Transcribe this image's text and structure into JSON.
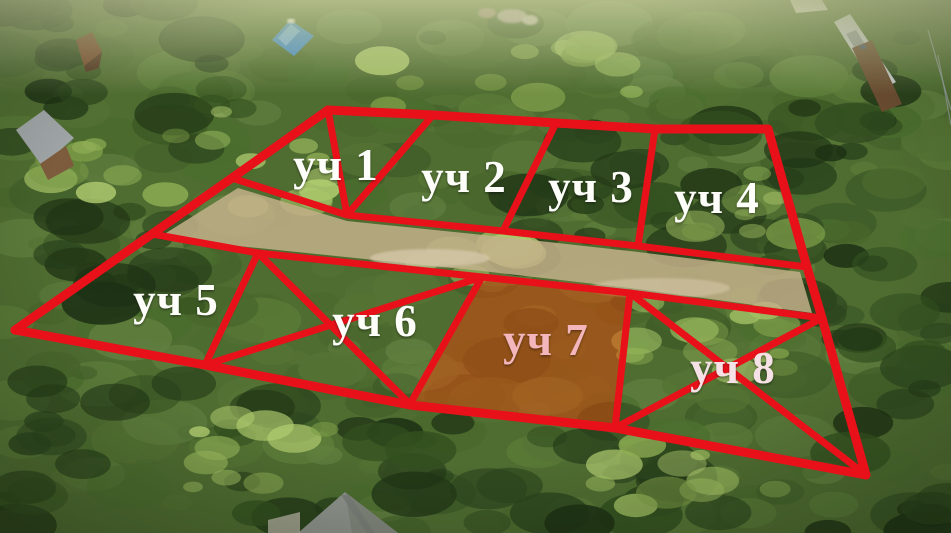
{
  "plots": [
    {
      "id": "1",
      "label": "уч 1",
      "x": 336,
      "y": 164,
      "color": "#fdfdfa"
    },
    {
      "id": "2",
      "label": "уч 2",
      "x": 464,
      "y": 176,
      "color": "#fdfdfa"
    },
    {
      "id": "3",
      "label": "уч 3",
      "x": 591,
      "y": 186,
      "color": "#fdfdfa"
    },
    {
      "id": "4",
      "label": "уч 4",
      "x": 717,
      "y": 197,
      "color": "#fdfdfa"
    },
    {
      "id": "5",
      "label": "уч 5",
      "x": 176,
      "y": 299,
      "color": "#fdfdfa"
    },
    {
      "id": "6",
      "label": "уч 6",
      "x": 375,
      "y": 320,
      "color": "#fdfdfa"
    },
    {
      "id": "7",
      "label": "уч 7",
      "x": 546,
      "y": 339,
      "color": "#f2b6bc"
    },
    {
      "id": "8",
      "label": "уч 8",
      "x": 733,
      "y": 367,
      "color": "#f6e2e6"
    }
  ],
  "overlay": {
    "stroke": "#e8111a",
    "outer_width": 9,
    "inner_width": 7,
    "highlight": {
      "name": "plot-7-highlight",
      "points": "482,277 630,293 615,428 410,404",
      "fill": "#ff3c00",
      "opacity": 0.42
    },
    "lines": [
      {
        "name": "outer-top-edge",
        "points": "328,110 433,115 556,123 655,129 768,129",
        "outer": true
      },
      {
        "name": "outer-right-edge",
        "points": "768,129 807,267 822,318 866,475",
        "outer": true
      },
      {
        "name": "outer-bottom-edge",
        "points": "15,330 205,365 410,405 615,428 866,475",
        "outer": true
      },
      {
        "name": "outer-left-edge",
        "points": "328,110 232,178 152,234 15,330",
        "outer": true
      },
      {
        "name": "road-top-edge",
        "points": "232,178 347,215 503,231 638,246 807,267",
        "outer": false
      },
      {
        "name": "road-bottom-edge",
        "points": "152,234 258,253 482,277 630,293 822,318",
        "outer": false
      },
      {
        "name": "divider-plots-1-2",
        "points": "433,115 347,215",
        "outer": false
      },
      {
        "name": "divider-plots-2-3",
        "points": "556,123 503,231",
        "outer": false
      },
      {
        "name": "divider-plots-3-4",
        "points": "655,129 638,246",
        "outer": false
      },
      {
        "name": "divider-plots-5-6",
        "points": "258,253 205,365",
        "outer": false
      },
      {
        "name": "divider-plots-6-7",
        "points": "482,277 410,404",
        "outer": false
      },
      {
        "name": "divider-plots-7-8",
        "points": "630,293 615,428",
        "outer": false
      },
      {
        "name": "plot-1-diagonal",
        "points": "328,110 347,215",
        "outer": false
      },
      {
        "name": "plot-6-diagonal-a",
        "points": "258,253 410,404",
        "outer": false
      },
      {
        "name": "plot-6-diagonal-b",
        "points": "482,277 205,365",
        "outer": false
      },
      {
        "name": "plot-8-diagonal-a",
        "points": "630,293 866,475",
        "outer": false
      },
      {
        "name": "plot-8-diagonal-b",
        "points": "822,318 615,428",
        "outer": false
      }
    ]
  },
  "photo": {
    "base_color": "#4f6c31",
    "haze_color": "#c9cf9e",
    "mid_palette": [
      "#49672c",
      "#557334",
      "#3f5c28",
      "#5d7d3a",
      "#4a6d2e",
      "#618040"
    ],
    "dark_palette": [
      "#243a18",
      "#2c451e",
      "#1d3114",
      "#33501f"
    ],
    "light_palette": [
      "#7d9c48",
      "#8fae55",
      "#a3c164",
      "#b4cf72",
      "#97b75c"
    ],
    "dark_regions": [
      [
        0,
        0,
        250,
        150,
        22
      ],
      [
        520,
        120,
        260,
        150,
        22
      ],
      [
        755,
        60,
        196,
        280,
        26
      ],
      [
        60,
        190,
        140,
        150,
        16
      ],
      [
        300,
        420,
        420,
        113,
        26
      ],
      [
        0,
        360,
        300,
        173,
        22
      ],
      [
        820,
        280,
        131,
        253,
        18
      ]
    ],
    "light_regions": [
      [
        150,
        110,
        180,
        110,
        12
      ],
      [
        180,
        415,
        150,
        80,
        10
      ],
      [
        615,
        290,
        200,
        100,
        14
      ],
      [
        360,
        40,
        300,
        70,
        12
      ],
      [
        600,
        430,
        180,
        80,
        10
      ],
      [
        20,
        140,
        120,
        80,
        8
      ],
      [
        420,
        240,
        120,
        40,
        6
      ],
      [
        690,
        170,
        110,
        80,
        8
      ]
    ],
    "features": [
      {
        "name": "dirt-road",
        "type": "poly",
        "points": "238,188 347,221 503,237 638,252 800,272 812,313 630,288 482,271 258,248 158,238",
        "fill": "#c3b08a",
        "opacity": 0.85
      },
      {
        "name": "road-gravel-patch-1",
        "type": "ellipse",
        "cx": 430,
        "cy": 258,
        "rx": 60,
        "ry": 9,
        "fill": "#d8cbae",
        "opacity": 0.7
      },
      {
        "name": "road-gravel-patch-2",
        "type": "ellipse",
        "cx": 660,
        "cy": 288,
        "rx": 70,
        "ry": 10,
        "fill": "#d4c6a6",
        "opacity": 0.6
      },
      {
        "name": "blue-roof-house",
        "type": "poly",
        "points": "272,40 290,20 314,36 294,56",
        "fill": "#3f87c7",
        "opacity": 1
      },
      {
        "name": "blue-roof-ridge",
        "type": "poly",
        "points": "278,38 291,24 300,31 286,46",
        "fill": "#6fa9dc",
        "opacity": 1
      },
      {
        "name": "blue-roof-chimney",
        "type": "ellipse",
        "cx": 291,
        "cy": 21,
        "rx": 4,
        "ry": 2.5,
        "fill": "#e8e4da",
        "opacity": 1
      },
      {
        "name": "brown-house-roof",
        "type": "poly",
        "points": "76,40 92,32 102,52 84,66",
        "fill": "#74452a",
        "opacity": 1
      },
      {
        "name": "brown-house-side",
        "type": "poly",
        "points": "84,66 102,52 99,68 86,72",
        "fill": "#4e2e1c",
        "opacity": 1
      },
      {
        "name": "left-house-roof",
        "type": "poly",
        "points": "16,130 44,110 74,138 42,166",
        "fill": "#9fa4a6",
        "opacity": 1
      },
      {
        "name": "left-house-wall",
        "type": "poly",
        "points": "40,164 66,146 74,166 48,180",
        "fill": "#7d5c3d",
        "opacity": 1
      },
      {
        "name": "distant-roof-1",
        "type": "ellipse",
        "cx": 512,
        "cy": 16,
        "rx": 15,
        "ry": 7,
        "fill": "#b5a7a2",
        "opacity": 0.95
      },
      {
        "name": "distant-roof-2",
        "type": "ellipse",
        "cx": 487,
        "cy": 13,
        "rx": 9,
        "ry": 5,
        "fill": "#a18a78",
        "opacity": 0.95
      },
      {
        "name": "distant-roof-3",
        "type": "ellipse",
        "cx": 530,
        "cy": 20,
        "rx": 8,
        "ry": 5,
        "fill": "#cbc4bc",
        "opacity": 0.9
      },
      {
        "name": "railway-platform",
        "type": "poly",
        "points": "834,22 850,14 896,82 878,92",
        "fill": "#c6c9cb",
        "opacity": 1
      },
      {
        "name": "railway-platform-shadow",
        "type": "poly",
        "points": "846,34 856,30 886,78 876,83",
        "fill": "#8b8f93",
        "opacity": 0.8
      },
      {
        "name": "railway-embankment",
        "type": "poly",
        "points": "852,48 872,40 902,104 882,112",
        "fill": "#6a4c31",
        "opacity": 1
      },
      {
        "name": "railway-person-dot",
        "type": "ellipse",
        "cx": 863,
        "cy": 47,
        "rx": 3,
        "ry": 2,
        "fill": "#3a5a88",
        "opacity": 1
      },
      {
        "name": "small-pale-roof",
        "type": "poly",
        "points": "790,0 822,0 828,10 796,13",
        "fill": "#d9d4c9",
        "opacity": 1
      },
      {
        "name": "power-line-1",
        "type": "stroke-line",
        "x1": 928,
        "y1": 30,
        "x2": 951,
        "y2": 110,
        "stroke": "#9aa3a8",
        "w": 1.2,
        "opacity": 0.8
      },
      {
        "name": "power-line-2",
        "type": "stroke-line",
        "x1": 938,
        "y1": 55,
        "x2": 951,
        "y2": 125,
        "stroke": "#9aa3a8",
        "w": 1.2,
        "opacity": 0.7
      },
      {
        "name": "bottom-house-roof",
        "type": "poly",
        "points": "298,533 345,492 398,533",
        "fill": "#90958f",
        "opacity": 1
      },
      {
        "name": "bottom-house-roof-right-face",
        "type": "poly",
        "points": "345,492 398,533 352,533",
        "fill": "#83887f",
        "opacity": 1
      },
      {
        "name": "bottom-house-ridge",
        "type": "poly",
        "points": "341,495 349,495 375,533 367,533",
        "fill": "#7b807b",
        "opacity": 0.9
      },
      {
        "name": "bottom-wall",
        "type": "poly",
        "points": "268,520 300,512 300,533 268,533",
        "fill": "#b9b4a6",
        "opacity": 0.8
      }
    ]
  }
}
